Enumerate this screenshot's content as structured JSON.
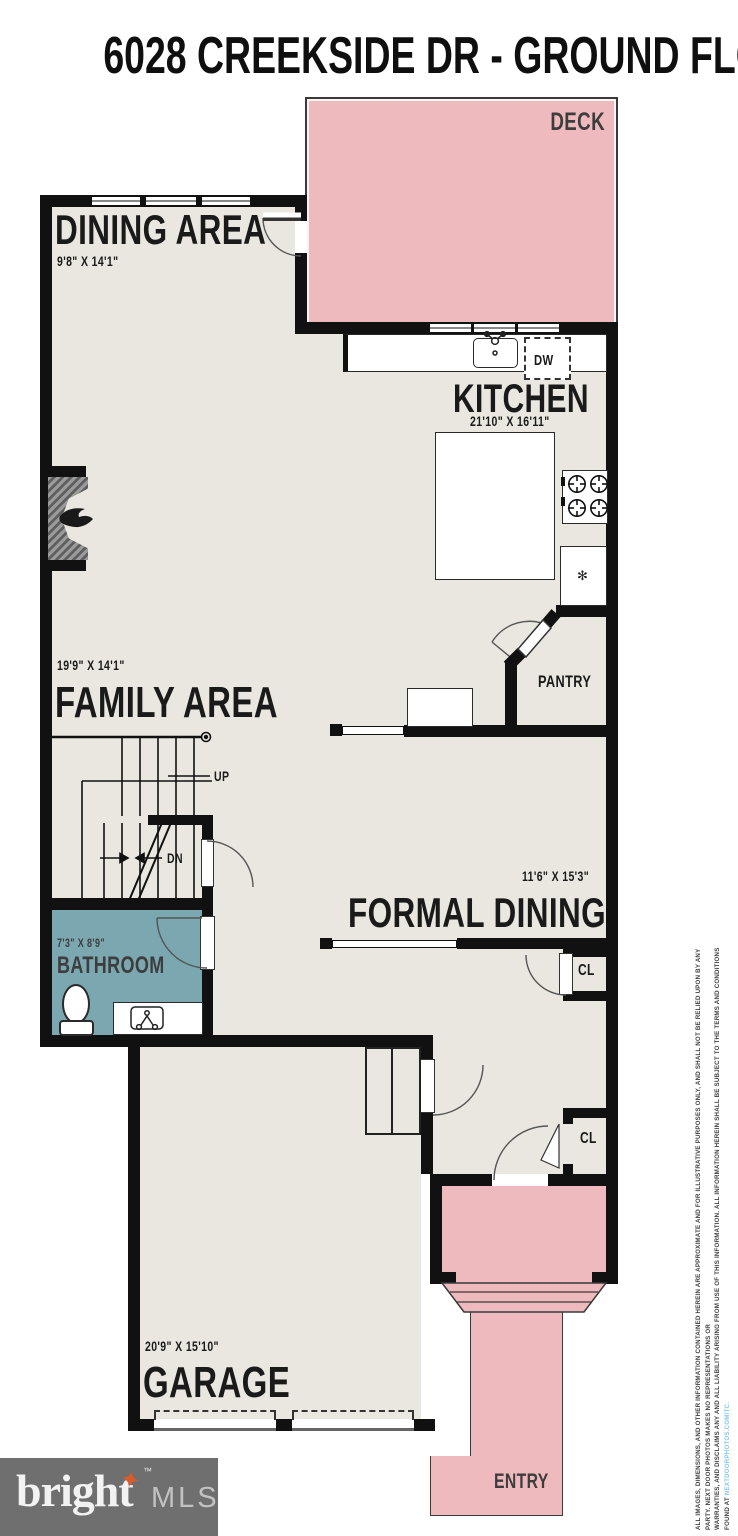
{
  "title": "6028 CREEKSIDE DR - GROUND FLOOR",
  "rooms": {
    "deck": {
      "label": "DECK"
    },
    "dining_area": {
      "label": "DINING AREA",
      "dimensions": "9'8\" X 14'1\""
    },
    "kitchen": {
      "label": "KITCHEN",
      "dimensions": "21'10\" X 16'11\""
    },
    "pantry": {
      "label": "PANTRY"
    },
    "family_area": {
      "label": "FAMILY AREA",
      "dimensions": "19'9\" X 14'1\""
    },
    "formal_dining": {
      "label": "FORMAL DINING",
      "dimensions": "11'6\" X 15'3\""
    },
    "bathroom": {
      "label": "BATHROOM",
      "dimensions": "7'3\" X 8'9\""
    },
    "garage": {
      "label": "GARAGE",
      "dimensions": "20'9\" X 15'10\""
    },
    "entry": {
      "label": "ENTRY"
    }
  },
  "annotations": {
    "stairs_up": "UP",
    "stairs_down": "DN",
    "dishwasher": "DW",
    "closet_formal_dining": "CL",
    "closet_entry": "CL"
  },
  "footer_logo": {
    "brand": "bright",
    "trademark": "™",
    "suffix": "MLS",
    "star": "✦"
  },
  "disclaimer": {
    "line1": "ALL IMAGES, DIMENSIONS, AND OTHER INFORMATION CONTAINED HEREIN ARE APPROXIMATE AND FOR ILLUSTRATIVE PURPOSES ONLY, AND SHALL NOT BE RELIED UPON BY ANY PARTY. NEXT DOOR PHOTOS MAKES NO REPRESENTATIONS OR",
    "line2_prefix": "WARRANTIES, AND DISCLAIMS ANY AND ALL LIABILITY ARISING FROM USE OF THIS INFORMATION. ALL INFORMATION HEREIN SHALL BE SUBJECT TO THE TERMS AND CONDITIONS FOUND AT ",
    "line2_link": "NEXTDOORPHOTOS.COM/TC."
  },
  "colors": {
    "deck_pink": "#eebabd",
    "floor_beige": "#e9e7df",
    "bathroom_teal": "#7ba7b1",
    "wall_black": "#111111",
    "logo_grey": "#6f6f6f",
    "logo_orange": "#d95b2b",
    "link_blue": "#85c7e8"
  }
}
